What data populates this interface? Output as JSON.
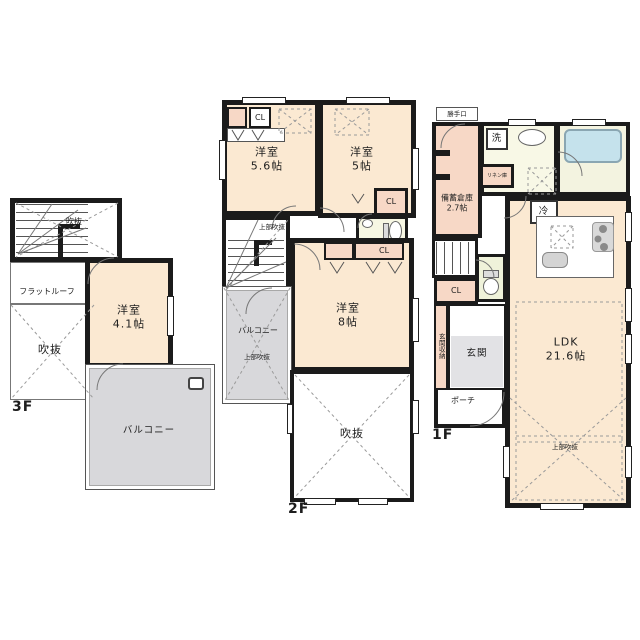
{
  "colors": {
    "wall": "#1b1b1b",
    "room_peach": "#fbe9d2",
    "closet_pink": "#f7d8c6",
    "balcony_gray": "#d8d8db",
    "wet_area_yellow": "#f8f8e6",
    "bathtub_blue": "#c5e2ec",
    "entrance_gray": "#e2e2e5"
  },
  "f3": {
    "floor_label": "3F",
    "stair_void": "吹抜",
    "flat_roof": "フラットルーフ",
    "void": "吹抜",
    "room": {
      "name": "洋室",
      "size": "4.1帖"
    },
    "balcony": "バルコニー"
  },
  "f2": {
    "floor_label": "2F",
    "room_a": {
      "name": "洋室",
      "size": "5.6帖"
    },
    "room_b": {
      "name": "洋室",
      "size": "5帖"
    },
    "room_c": {
      "name": "洋室",
      "size": "8帖"
    },
    "closet": "CL",
    "stair_note": "上部吹抜",
    "balcony": "バルコニー",
    "balcony_note": "上部吹抜",
    "void": "吹抜"
  },
  "f1": {
    "floor_label": "1F",
    "back_door": "勝手口",
    "pantry": {
      "name": "備蓄倉庫",
      "size": "2.7帖"
    },
    "washer": "洗",
    "linen": "リネン庫",
    "fridge": "冷",
    "closet": "CL",
    "entrance_storage": "玄関収納",
    "entrance": "玄関",
    "porch": "ポーチ",
    "ldk": {
      "name": "LDK",
      "size": "21.6帖"
    },
    "void_note": "上部吹抜"
  }
}
